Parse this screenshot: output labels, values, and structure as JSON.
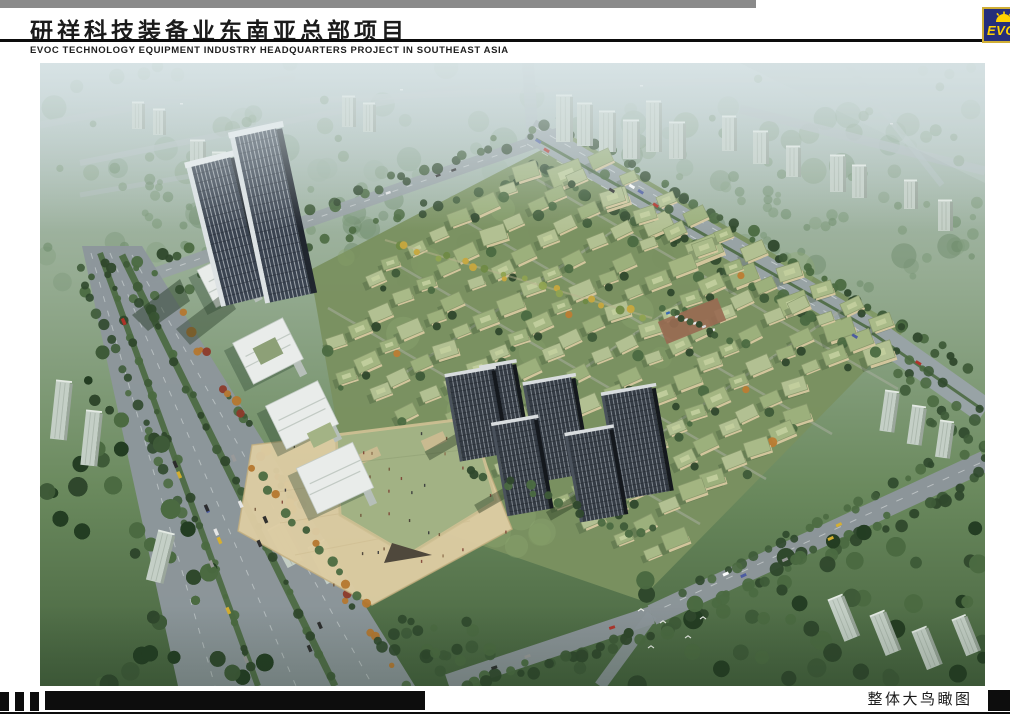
{
  "header": {
    "title_zh": "研祥科技装备业东南亚总部项目",
    "subtitle_en": "EVOC TECHNOLOGY EQUIPMENT INDUSTRY HEADQUARTERS PROJECT IN SOUTHEAST ASIA",
    "logo": {
      "text": "EVOC"
    }
  },
  "footer": {
    "caption": "整体大鸟瞰图"
  },
  "palette": {
    "ui": {
      "paper": "#ffffff",
      "ink": "#0d0d0d",
      "strip": "#8a8a8a",
      "title": "#1b1b1b",
      "caption": "#1a1a1a",
      "logo_navy": "#252e7b",
      "logo_gold": "#cfae36",
      "logo_yellow": "#ffd200"
    },
    "scene": {
      "site": "#7a9160",
      "road": "#8d969b",
      "road_pale": "#b3bfbf",
      "median_green": "#4d6a43",
      "plaza": "#dccba2",
      "mall_roof": "#a2b284",
      "wall": "#d8c9a0",
      "tower_dark": "#3a4350",
      "hirise_dark": "#343b44",
      "slab": "#c4cfc6",
      "trees": [
        "#3e5b38",
        "#4b6a41",
        "#2f482c"
      ],
      "roof": [
        "#a9ba88",
        "#9cb07c",
        "#b2c092",
        "#a3b581"
      ],
      "autumn": [
        "#b5772f",
        "#8d3a2a",
        "#c7a83e"
      ]
    }
  }
}
